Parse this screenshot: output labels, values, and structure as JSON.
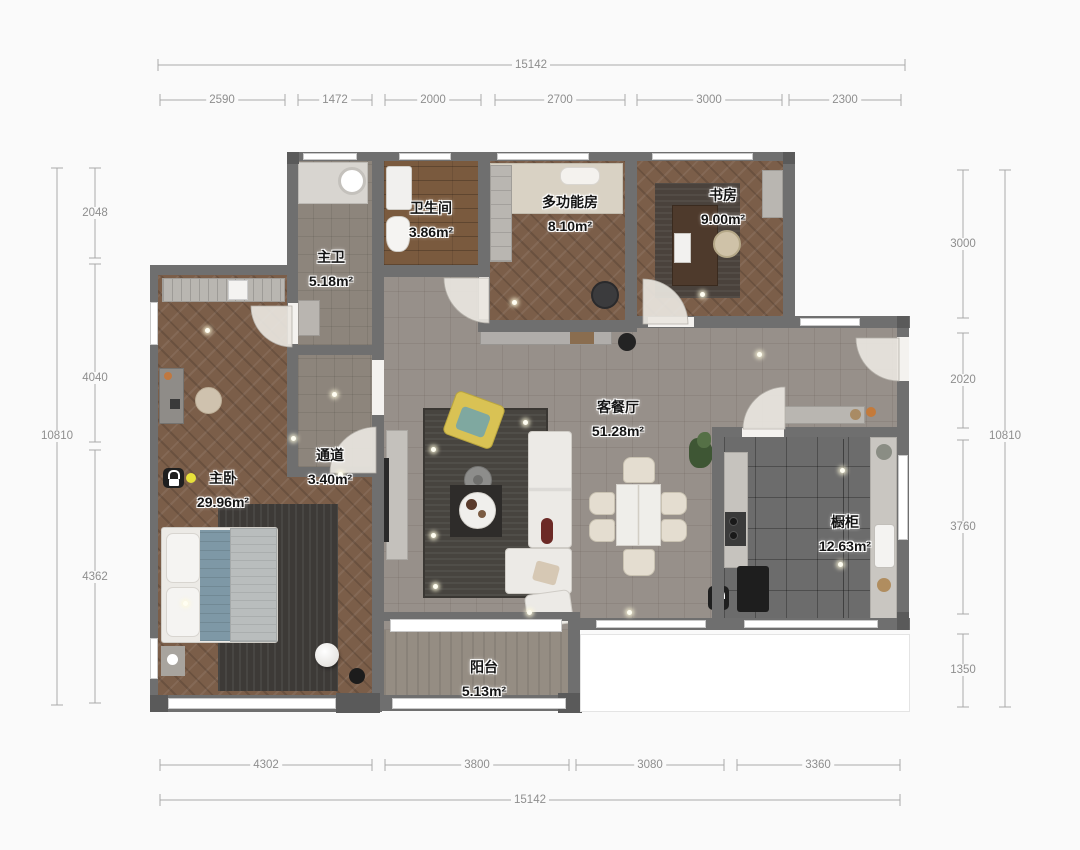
{
  "plan": {
    "rooms": {
      "master_bath": {
        "name": "主卫",
        "area": "5.18m²"
      },
      "bathroom": {
        "name": "卫生间",
        "area": "3.86m²"
      },
      "multi_room": {
        "name": "多功能房",
        "area": "8.10m²"
      },
      "study": {
        "name": "书房",
        "area": "9.00m²"
      },
      "living_dining": {
        "name": "客餐厅",
        "area": "51.28m²"
      },
      "corridor": {
        "name": "通道",
        "area": "3.40m²"
      },
      "master_bedroom": {
        "name": "主卧",
        "area": "29.96m²"
      },
      "kitchen": {
        "name": "橱柜",
        "area": "12.63m²"
      },
      "balcony": {
        "name": "阳台",
        "area": "5.13m²"
      }
    },
    "dimensions": {
      "top_total": "15142",
      "top_segments": [
        "2590",
        "1472",
        "2000",
        "2700",
        "3000",
        "2300"
      ],
      "left_total": "10810",
      "left_segments": [
        "2048",
        "4040",
        "4362"
      ],
      "right_total": "10810",
      "right_segments": [
        "3000",
        "2020",
        "3760",
        "1350"
      ],
      "bottom_total": "15142",
      "bottom_segments": [
        "4302",
        "3800",
        "3080",
        "3360"
      ]
    },
    "colors": {
      "wall": "#6f6f6f",
      "parquet_floor": "#7b5e49",
      "living_floor": "#97908a",
      "kitchen_floor": "#6c6c6c",
      "tile_floor": "#8d857c",
      "dark_rug": "#3d3a37",
      "beanbag_yellow": "#d9c254",
      "pillow_teal": "#7fa8a0",
      "lock_dot_yellow": "#e8e13a",
      "dimension_text": "#8e8e8e"
    }
  }
}
